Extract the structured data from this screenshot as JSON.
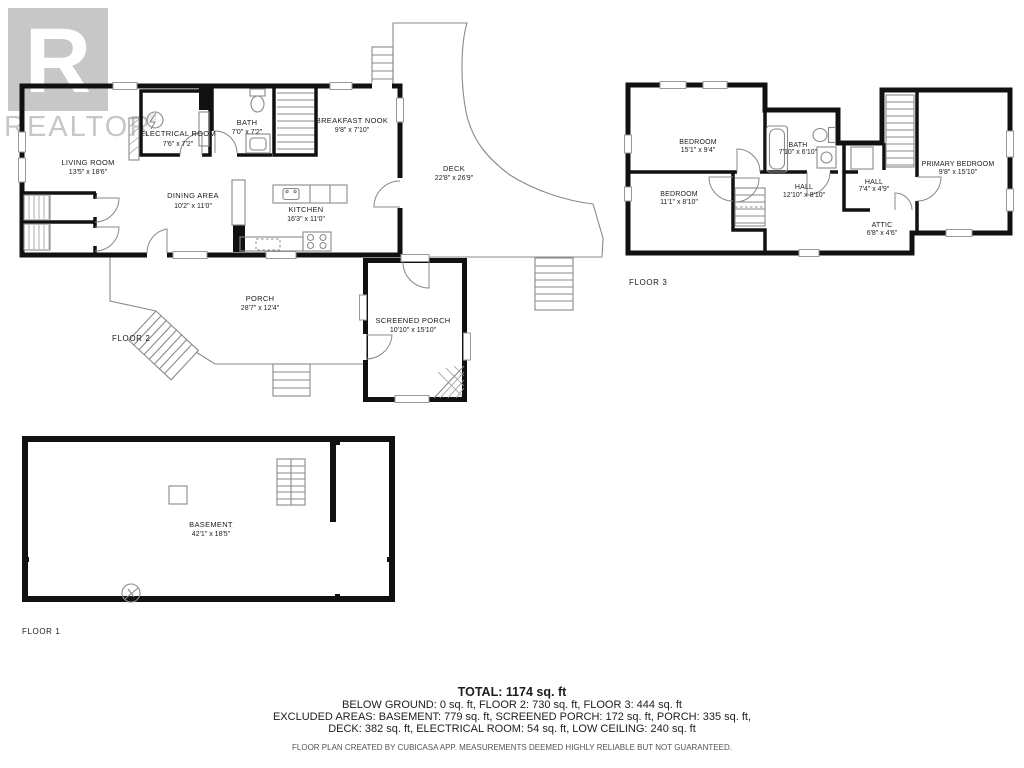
{
  "watermark": {
    "letter": "R",
    "brand": "REALTOR",
    "registered": "®"
  },
  "floors": {
    "floor2": {
      "label": "FLOOR 2",
      "rooms": {
        "living": {
          "name": "LIVING ROOM",
          "dims": "13'5\" x 18'6\""
        },
        "electrical": {
          "name": "ELECTRICAL ROOM",
          "dims": "7'6\" x 7'2\""
        },
        "bath": {
          "name": "BATH",
          "dims": "7'0\" x 7'2\""
        },
        "nook": {
          "name": "BREAKFAST NOOK",
          "dims": "9'8\" x 7'10\""
        },
        "deck": {
          "name": "DECK",
          "dims": "22'8\" x 26'9\""
        },
        "dining": {
          "name": "DINING AREA",
          "dims": "10'2\" x 11'0\""
        },
        "kitchen": {
          "name": "KITCHEN",
          "dims": "16'3\" x 11'0\""
        },
        "porch": {
          "name": "PORCH",
          "dims": "28'7\" x 12'4\""
        },
        "screened": {
          "name": "SCREENED PORCH",
          "dims": "10'10\" x 15'10\""
        }
      }
    },
    "floor3": {
      "label": "FLOOR 3",
      "rooms": {
        "bedroom1": {
          "name": "BEDROOM",
          "dims": "15'1\" x 9'4\""
        },
        "bedroom2": {
          "name": "BEDROOM",
          "dims": "11'1\" x 8'10\""
        },
        "bath": {
          "name": "BATH",
          "dims": "7'10\" x 6'10\""
        },
        "hall1": {
          "name": "HALL",
          "dims": "12'10\" x 8'10\""
        },
        "hall2": {
          "name": "HALL",
          "dims": "7'4\" x 4'9\""
        },
        "attic": {
          "name": "ATTIC",
          "dims": "6'8\" x 4'6\""
        },
        "primary": {
          "name": "PRIMARY BEDROOM",
          "dims": "9'8\" x 15'10\""
        }
      }
    },
    "floor1": {
      "label": "FLOOR 1",
      "rooms": {
        "basement": {
          "name": "BASEMENT",
          "dims": "42'1\" x 18'5\""
        }
      }
    }
  },
  "summary": {
    "total": "TOTAL: 1174 sq. ft",
    "line1": "BELOW GROUND: 0 sq. ft, FLOOR 2: 730 sq. ft, FLOOR 3: 444 sq. ft",
    "line2": "EXCLUDED AREAS: BASEMENT: 779 sq. ft, SCREENED PORCH: 172 sq. ft, PORCH: 335 sq. ft,",
    "line3": "DECK: 382 sq. ft, ELECTRICAL ROOM: 54 sq. ft, LOW CEILING: 240 sq. ft",
    "disclaimer": "FLOOR PLAN CREATED BY CUBICASA APP. MEASUREMENTS DEEMED HIGHLY RELIABLE BUT NOT GUARANTEED."
  },
  "colors": {
    "wall": "#111111",
    "thin_line": "#8a8a8a",
    "watermark": "#c7c7c7",
    "text": "#1c1c1c"
  }
}
